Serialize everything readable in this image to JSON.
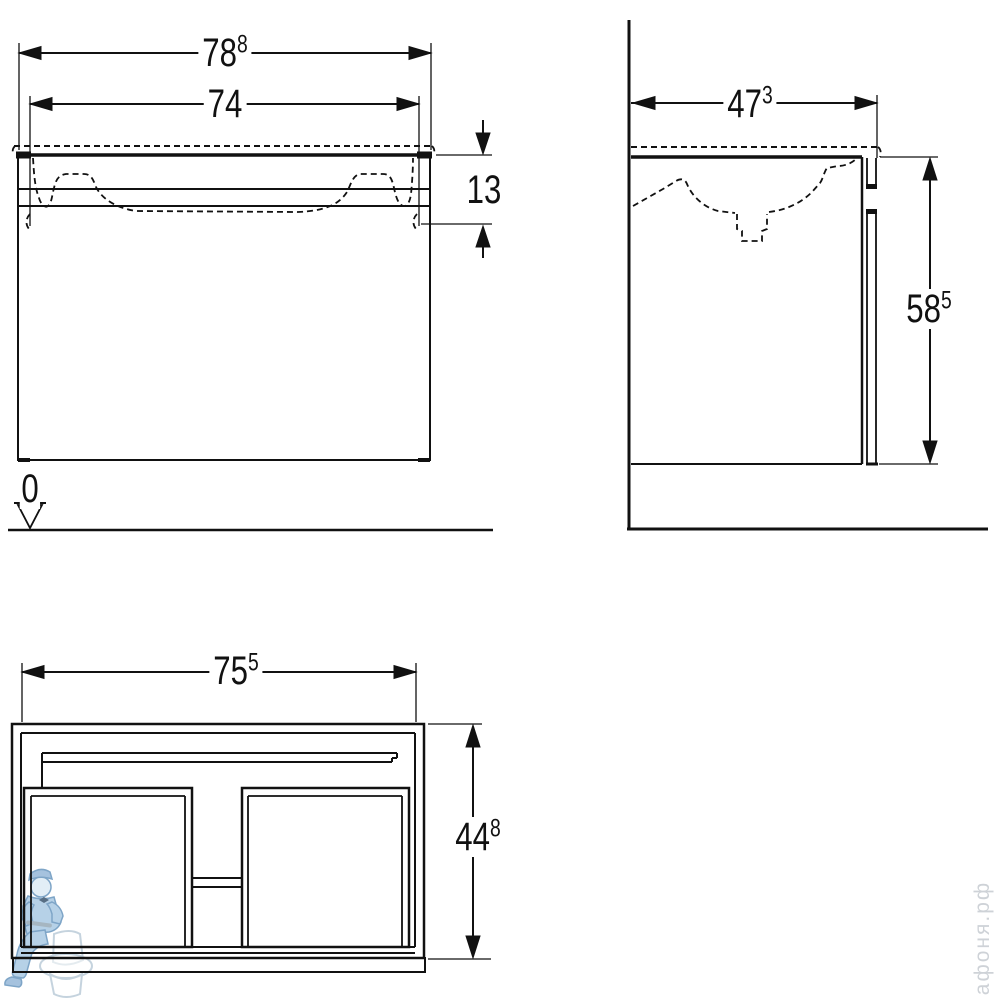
{
  "drawing": {
    "front_view": {
      "overall_width": {
        "value": "78",
        "sup": "8"
      },
      "basin_width": {
        "value": "74",
        "sup": ""
      },
      "apron_height": {
        "value": "13",
        "sup": ""
      },
      "floor_level": {
        "value": "0",
        "sup": ""
      }
    },
    "side_view": {
      "depth": {
        "value": "47",
        "sup": "3"
      },
      "height_above_floor": {
        "value": "58",
        "sup": "5"
      }
    },
    "cabinet_view": {
      "width": {
        "value": "75",
        "sup": "5"
      },
      "height": {
        "value": "44",
        "sup": "8"
      }
    }
  },
  "watermark": {
    "site": "афоня.рф",
    "figure": "plumber-on-toilet"
  },
  "colors": {
    "line": "#111111",
    "background": "#ffffff",
    "watermark_blue": "#a5c6e2",
    "watermark_text": "#c6cbd1"
  }
}
